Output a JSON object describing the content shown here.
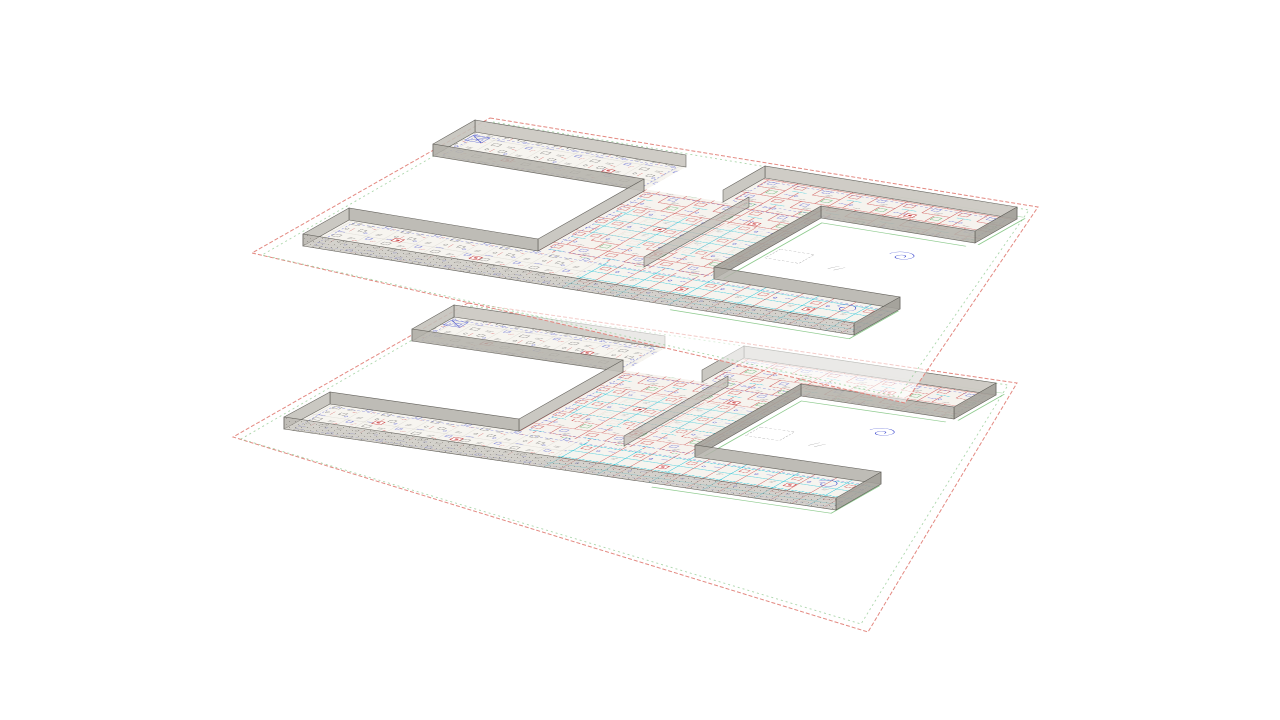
{
  "scene": {
    "type": "3d-stacked-floor-plans",
    "floor_count": 2,
    "floors": [
      {
        "id": "upper-level",
        "footprint": "comb-with-two-courtyards"
      },
      {
        "id": "lower-level",
        "footprint": "comb-with-two-courtyards"
      }
    ]
  },
  "colors": {
    "background": "#ffffff",
    "sheet_frame_red": "#e2837b",
    "sheet_frame_green": "#9ccf9c",
    "wall_grey_light": "#cbc8c1",
    "wall_grey_medium": "#b3b0a9",
    "wall_grey_dark": "#a29f98",
    "floor_paper": "#f6f4ef",
    "plan_red": "#c63030",
    "plan_blue": "#3a44cc",
    "plan_cyan": "#00bcd4",
    "plan_green": "#2f9e44",
    "plan_black": "#3c3c3c",
    "site_green": "#72bd72"
  }
}
